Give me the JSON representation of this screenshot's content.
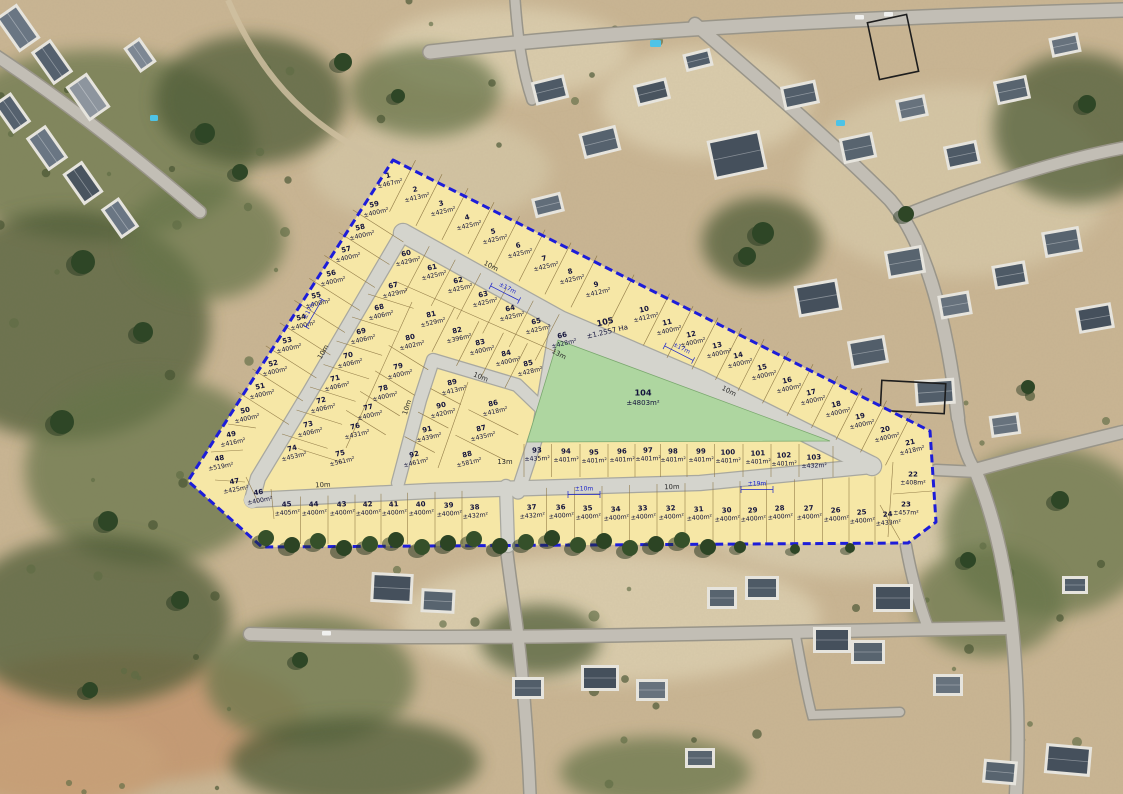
{
  "title": "Aerial photograph with township layout plan overlay — numbered erven with areas",
  "colors": {
    "boundary": "#1d1dd9",
    "plot_fill": "#f6e7a6",
    "road_fill": "#d4d4cd",
    "park_fill": "#aed6a0",
    "label_text": "#14143c",
    "dimension_text": "#1821c8",
    "sand": "#c9b593"
  },
  "erven": [
    {
      "n": "1",
      "a": "±467m²",
      "x": 389,
      "y": 179,
      "r": -13
    },
    {
      "n": "2",
      "a": "±413m²",
      "x": 416,
      "y": 193,
      "r": -13
    },
    {
      "n": "3",
      "a": "±425m²",
      "x": 442,
      "y": 207,
      "r": -13
    },
    {
      "n": "4",
      "a": "±425m²",
      "x": 468,
      "y": 221,
      "r": -13
    },
    {
      "n": "5",
      "a": "±425m²",
      "x": 494,
      "y": 235,
      "r": -13
    },
    {
      "n": "6",
      "a": "±425m²",
      "x": 519,
      "y": 249,
      "r": -13
    },
    {
      "n": "7",
      "a": "±425m²",
      "x": 545,
      "y": 262,
      "r": -13
    },
    {
      "n": "8",
      "a": "±425m²",
      "x": 571,
      "y": 275,
      "r": -13
    },
    {
      "n": "9",
      "a": "±412m²",
      "x": 597,
      "y": 288,
      "r": -13
    },
    {
      "n": "10",
      "a": "±412m²",
      "x": 645,
      "y": 313,
      "r": -13
    },
    {
      "n": "11",
      "a": "±400m²",
      "x": 668,
      "y": 326,
      "r": -13
    },
    {
      "n": "12",
      "a": "±400m²",
      "x": 692,
      "y": 338,
      "r": -13
    },
    {
      "n": "13",
      "a": "±400m²",
      "x": 718,
      "y": 349,
      "r": -13
    },
    {
      "n": "14",
      "a": "±400m²",
      "x": 739,
      "y": 359,
      "r": -13
    },
    {
      "n": "15",
      "a": "±400m²",
      "x": 763,
      "y": 371,
      "r": -13
    },
    {
      "n": "16",
      "a": "±400m²",
      "x": 788,
      "y": 384,
      "r": -13
    },
    {
      "n": "17",
      "a": "±400m²",
      "x": 812,
      "y": 396,
      "r": -13
    },
    {
      "n": "18",
      "a": "±400m²",
      "x": 837,
      "y": 408,
      "r": -13
    },
    {
      "n": "19",
      "a": "±400m²",
      "x": 861,
      "y": 420,
      "r": -13
    },
    {
      "n": "20",
      "a": "±400m²",
      "x": 886,
      "y": 433,
      "r": -13
    },
    {
      "n": "21",
      "a": "±418m²",
      "x": 911,
      "y": 446,
      "r": -13
    },
    {
      "n": "22",
      "a": "±408m²",
      "x": 913,
      "y": 478,
      "r": 0
    },
    {
      "n": "23",
      "a": "±457m²",
      "x": 906,
      "y": 508,
      "r": 0
    },
    {
      "n": "24",
      "a": "±433m²",
      "x": 888,
      "y": 518,
      "r": -5
    },
    {
      "n": "25",
      "a": "±400m²",
      "x": 862,
      "y": 516,
      "r": -5
    },
    {
      "n": "26",
      "a": "±400m²",
      "x": 836,
      "y": 514,
      "r": -5
    },
    {
      "n": "27",
      "a": "±400m²",
      "x": 809,
      "y": 512,
      "r": -5
    },
    {
      "n": "28",
      "a": "±400m²",
      "x": 780,
      "y": 512,
      "r": -5
    },
    {
      "n": "29",
      "a": "±400m²",
      "x": 753,
      "y": 514,
      "r": -5
    },
    {
      "n": "30",
      "a": "±400m²",
      "x": 727,
      "y": 514,
      "r": -5
    },
    {
      "n": "31",
      "a": "±400m²",
      "x": 699,
      "y": 513,
      "r": -5
    },
    {
      "n": "32",
      "a": "±400m²",
      "x": 671,
      "y": 512,
      "r": -5
    },
    {
      "n": "33",
      "a": "±400m²",
      "x": 643,
      "y": 512,
      "r": -5
    },
    {
      "n": "34",
      "a": "±400m²",
      "x": 616,
      "y": 513,
      "r": -5
    },
    {
      "n": "35",
      "a": "±400m²",
      "x": 588,
      "y": 512,
      "r": -5
    },
    {
      "n": "36",
      "a": "±400m²",
      "x": 561,
      "y": 511,
      "r": -5
    },
    {
      "n": "37",
      "a": "±432m²",
      "x": 532,
      "y": 511,
      "r": -5
    },
    {
      "n": "38",
      "a": "±432m²",
      "x": 475,
      "y": 511,
      "r": -5
    },
    {
      "n": "39",
      "a": "±400m²",
      "x": 449,
      "y": 509,
      "r": -5
    },
    {
      "n": "40",
      "a": "±400m²",
      "x": 421,
      "y": 508,
      "r": -5
    },
    {
      "n": "41",
      "a": "±400m²",
      "x": 394,
      "y": 508,
      "r": -5
    },
    {
      "n": "42",
      "a": "±400m²",
      "x": 368,
      "y": 508,
      "r": -5
    },
    {
      "n": "43",
      "a": "±400m²",
      "x": 342,
      "y": 508,
      "r": -5
    },
    {
      "n": "44",
      "a": "±400m²",
      "x": 314,
      "y": 508,
      "r": -5
    },
    {
      "n": "45",
      "a": "±405m²",
      "x": 287,
      "y": 508,
      "r": -5
    },
    {
      "n": "46",
      "a": "±400m²",
      "x": 259,
      "y": 496,
      "r": -10
    },
    {
      "n": "47",
      "a": "±425m²",
      "x": 235,
      "y": 485,
      "r": -10
    },
    {
      "n": "48",
      "a": "±519m²",
      "x": 220,
      "y": 462,
      "r": -10
    },
    {
      "n": "49",
      "a": "±416m²",
      "x": 232,
      "y": 438,
      "r": -12
    },
    {
      "n": "50",
      "a": "±400m²",
      "x": 246,
      "y": 414,
      "r": -13
    },
    {
      "n": "51",
      "a": "±400m²",
      "x": 261,
      "y": 390,
      "r": -13
    },
    {
      "n": "52",
      "a": "±400m²",
      "x": 274,
      "y": 367,
      "r": -13
    },
    {
      "n": "53",
      "a": "±400m²",
      "x": 288,
      "y": 344,
      "r": -13
    },
    {
      "n": "54",
      "a": "±400m²",
      "x": 302,
      "y": 321,
      "r": -13
    },
    {
      "n": "55",
      "a": "±400m²",
      "x": 317,
      "y": 299,
      "r": -13
    },
    {
      "n": "56",
      "a": "±400m²",
      "x": 332,
      "y": 277,
      "r": -13
    },
    {
      "n": "57",
      "a": "±400m²",
      "x": 347,
      "y": 253,
      "r": -13
    },
    {
      "n": "58",
      "a": "±400m²",
      "x": 361,
      "y": 231,
      "r": -13
    },
    {
      "n": "59",
      "a": "±400m²",
      "x": 375,
      "y": 208,
      "r": -13
    },
    {
      "n": "60",
      "a": "±429m²",
      "x": 407,
      "y": 257,
      "r": -13
    },
    {
      "n": "61",
      "a": "±425m²",
      "x": 433,
      "y": 271,
      "r": -13
    },
    {
      "n": "62",
      "a": "±425m²",
      "x": 459,
      "y": 284,
      "r": -13
    },
    {
      "n": "63",
      "a": "±425m²",
      "x": 484,
      "y": 298,
      "r": -13
    },
    {
      "n": "64",
      "a": "±425m²",
      "x": 511,
      "y": 312,
      "r": -13
    },
    {
      "n": "65",
      "a": "±425m²",
      "x": 537,
      "y": 325,
      "r": -13
    },
    {
      "n": "66",
      "a": "±428m²",
      "x": 563,
      "y": 339,
      "r": -13
    },
    {
      "n": "67",
      "a": "±429m²",
      "x": 394,
      "y": 289,
      "r": -13
    },
    {
      "n": "68",
      "a": "±406m²",
      "x": 380,
      "y": 311,
      "r": -13
    },
    {
      "n": "69",
      "a": "±406m²",
      "x": 362,
      "y": 335,
      "r": -13
    },
    {
      "n": "70",
      "a": "±406m²",
      "x": 349,
      "y": 359,
      "r": -13
    },
    {
      "n": "71",
      "a": "±406m²",
      "x": 336,
      "y": 382,
      "r": -13
    },
    {
      "n": "72",
      "a": "±406m²",
      "x": 322,
      "y": 404,
      "r": -13
    },
    {
      "n": "73",
      "a": "±406m²",
      "x": 309,
      "y": 428,
      "r": -13
    },
    {
      "n": "74",
      "a": "±453m²",
      "x": 293,
      "y": 452,
      "r": -13
    },
    {
      "n": "75",
      "a": "±561m²",
      "x": 341,
      "y": 457,
      "r": -13
    },
    {
      "n": "76",
      "a": "±431m²",
      "x": 356,
      "y": 430,
      "r": -13
    },
    {
      "n": "77",
      "a": "±400m²",
      "x": 369,
      "y": 411,
      "r": -13
    },
    {
      "n": "78",
      "a": "±400m²",
      "x": 384,
      "y": 392,
      "r": -13
    },
    {
      "n": "79",
      "a": "±400m²",
      "x": 399,
      "y": 370,
      "r": -13
    },
    {
      "n": "80",
      "a": "±402m²",
      "x": 411,
      "y": 341,
      "r": -13
    },
    {
      "n": "81",
      "a": "±529m²",
      "x": 432,
      "y": 318,
      "r": -13
    },
    {
      "n": "82",
      "a": "±396m²",
      "x": 458,
      "y": 334,
      "r": -13
    },
    {
      "n": "83",
      "a": "±400m²",
      "x": 481,
      "y": 346,
      "r": -13
    },
    {
      "n": "84",
      "a": "±400m²",
      "x": 507,
      "y": 357,
      "r": -13
    },
    {
      "n": "85",
      "a": "±428m²",
      "x": 529,
      "y": 367,
      "r": -13
    },
    {
      "n": "86",
      "a": "±418m²",
      "x": 494,
      "y": 407,
      "r": -13
    },
    {
      "n": "87",
      "a": "±435m²",
      "x": 482,
      "y": 432,
      "r": -13
    },
    {
      "n": "88",
      "a": "±581m²",
      "x": 468,
      "y": 458,
      "r": -13
    },
    {
      "n": "89",
      "a": "±413m²",
      "x": 453,
      "y": 386,
      "r": -13
    },
    {
      "n": "90",
      "a": "±420m²",
      "x": 442,
      "y": 409,
      "r": -13
    },
    {
      "n": "91",
      "a": "±439m²",
      "x": 428,
      "y": 433,
      "r": -13
    },
    {
      "n": "92",
      "a": "±461m²",
      "x": 415,
      "y": 458,
      "r": -13
    },
    {
      "n": "93",
      "a": "±435m²",
      "x": 537,
      "y": 454,
      "r": -2
    },
    {
      "n": "94",
      "a": "±401m²",
      "x": 566,
      "y": 455,
      "r": -2
    },
    {
      "n": "95",
      "a": "±401m²",
      "x": 594,
      "y": 456,
      "r": -2
    },
    {
      "n": "96",
      "a": "±401m²",
      "x": 622,
      "y": 455,
      "r": -2
    },
    {
      "n": "97",
      "a": "±401m²",
      "x": 648,
      "y": 454,
      "r": -2
    },
    {
      "n": "98",
      "a": "±401m²",
      "x": 673,
      "y": 455,
      "r": -2
    },
    {
      "n": "99",
      "a": "±401m²",
      "x": 701,
      "y": 455,
      "r": -2
    },
    {
      "n": "100",
      "a": "±401m²",
      "x": 728,
      "y": 456,
      "r": -2
    },
    {
      "n": "101",
      "a": "±401m²",
      "x": 758,
      "y": 457,
      "r": -2
    },
    {
      "n": "102",
      "a": "±401m²",
      "x": 784,
      "y": 459,
      "r": -2
    },
    {
      "n": "103",
      "a": "±432m²",
      "x": 814,
      "y": 461,
      "r": -2
    },
    {
      "n": "104",
      "a": "±4803m²",
      "x": 643,
      "y": 397,
      "r": 0,
      "kind": "open-space"
    },
    {
      "n": "105",
      "a": "±1.2557 Ha",
      "x": 606,
      "y": 326,
      "r": -13,
      "kind": "road-reserve"
    }
  ],
  "road_width_labels": [
    {
      "text": "10m",
      "x": 490,
      "y": 268,
      "r": 27
    },
    {
      "text": "10m",
      "x": 728,
      "y": 393,
      "r": 27
    },
    {
      "text": "10m",
      "x": 325,
      "y": 353,
      "r": -60
    },
    {
      "text": "10m",
      "x": 323,
      "y": 487,
      "r": -3
    },
    {
      "text": "10m",
      "x": 672,
      "y": 489,
      "r": -2
    },
    {
      "text": "10m",
      "x": 409,
      "y": 408,
      "r": -72
    },
    {
      "text": "10m",
      "x": 480,
      "y": 379,
      "r": 22
    },
    {
      "text": "13m",
      "x": 558,
      "y": 356,
      "r": 27
    },
    {
      "text": "13m",
      "x": 505,
      "y": 464,
      "r": 0
    }
  ],
  "dimension_labels": [
    {
      "text": "±17m",
      "x": 506,
      "y": 291,
      "r": 27
    },
    {
      "text": "±17m",
      "x": 680,
      "y": 351,
      "r": 27
    },
    {
      "text": "±17m",
      "x": 312,
      "y": 312,
      "r": -60
    },
    {
      "text": "±10m",
      "x": 584,
      "y": 492,
      "r": 0
    },
    {
      "text": "±19m",
      "x": 757,
      "y": 487,
      "r": 0
    }
  ]
}
